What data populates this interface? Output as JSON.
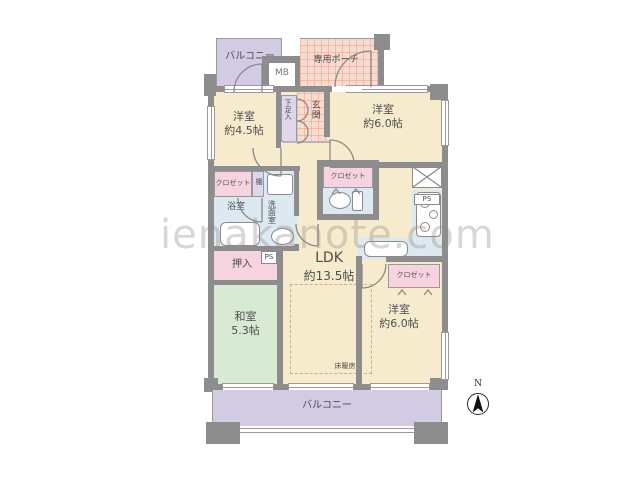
{
  "plan": {
    "title": "apartment-floor-plan",
    "watermark": "ienakanote.com",
    "compass": {
      "label": "N"
    },
    "balcony_top": {
      "label": "バルコニー"
    },
    "meter_box": {
      "label": "MB"
    },
    "porch": {
      "label": "専用ポーチ"
    },
    "shoe_box": {
      "label": "下足入"
    },
    "entrance": {
      "label": "玄関"
    },
    "west_room_a": {
      "name": "洋室",
      "size": "約4.5帖"
    },
    "west_room_b": {
      "name": "洋室",
      "size": "約6.0帖"
    },
    "west_room_c": {
      "name": "洋室",
      "size": "約6.0帖"
    },
    "closet_a": {
      "label": "クロゼット"
    },
    "closet_b": {
      "label": "クロゼット"
    },
    "closet_c": {
      "label": "クロゼット"
    },
    "shelf": {
      "label": "棚"
    },
    "bath": {
      "label": "浴室"
    },
    "washroom": {
      "label": "洗面室"
    },
    "pipe_space_a": {
      "label": "PS"
    },
    "pipe_space_b": {
      "label": "PS"
    },
    "oshiire": {
      "label": "押入"
    },
    "ldk": {
      "name": "LDK",
      "size": "約13.5帖"
    },
    "floor_heating": {
      "label": "床暖房"
    },
    "japanese_room": {
      "name": "和室",
      "size": "5.3帖"
    },
    "balcony_bottom": {
      "label": "バルコニー"
    },
    "colors": {
      "wall": "#8d8d8d",
      "room_cream": "#f7ebcd",
      "tatami_green": "#d9ead4",
      "balcony_purple": "#d3cae4",
      "entrance_pink": "#f8dcd0",
      "closet_pink": "#f7d3df",
      "wet_area_blue": "#dce9f0",
      "shoe_lavender": "#ddd6ec",
      "fixture_white": "#ffffff",
      "label_gray": "#4d4d4d"
    }
  }
}
